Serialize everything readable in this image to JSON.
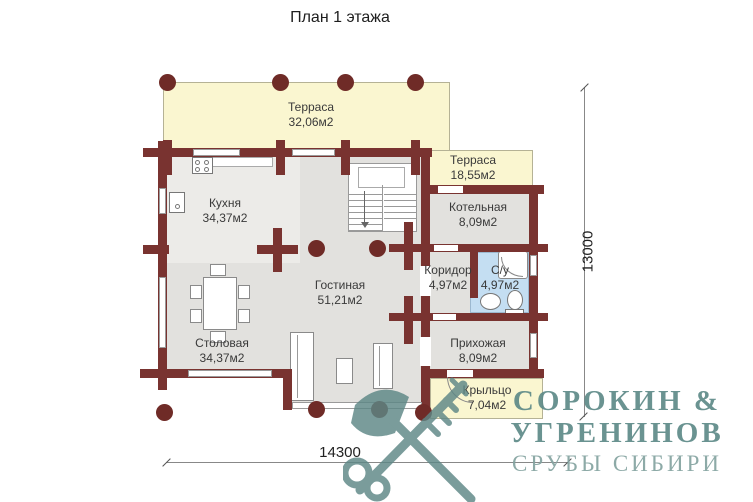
{
  "title": "План 1 этажа",
  "rooms": {
    "terrace_top": {
      "name": "Терраса",
      "area": "32,06м2"
    },
    "terrace_right": {
      "name": "Терраса",
      "area": "18,55м2"
    },
    "kitchen": {
      "name": "Кухня",
      "area": "34,37м2"
    },
    "boiler": {
      "name": "Котельная",
      "area": "8,09м2"
    },
    "living": {
      "name": "Гостиная",
      "area": "51,21м2"
    },
    "corridor": {
      "name": "Коридор",
      "area": "4,97м2"
    },
    "bathroom": {
      "name": "С/у",
      "area": "4,97м2"
    },
    "dining": {
      "name": "Столовая",
      "area": "34,37м2"
    },
    "hallway": {
      "name": "Прихожая",
      "area": "8,09м2"
    },
    "porch": {
      "name": "Крыльцо",
      "area": "7,04м2"
    }
  },
  "dimensions": {
    "bottom": "14300",
    "right": "13000"
  },
  "watermark": {
    "line1": "СОРОКИН &",
    "line2": "УГРЕНИНОВ",
    "line3": "СРУБЫ СИБИРИ"
  },
  "colors": {
    "wall": "#793330",
    "terrace": "#faf6d0",
    "floor": "#e2e1de",
    "bathroom": "#c4def2",
    "logo": "#5e8a88"
  }
}
